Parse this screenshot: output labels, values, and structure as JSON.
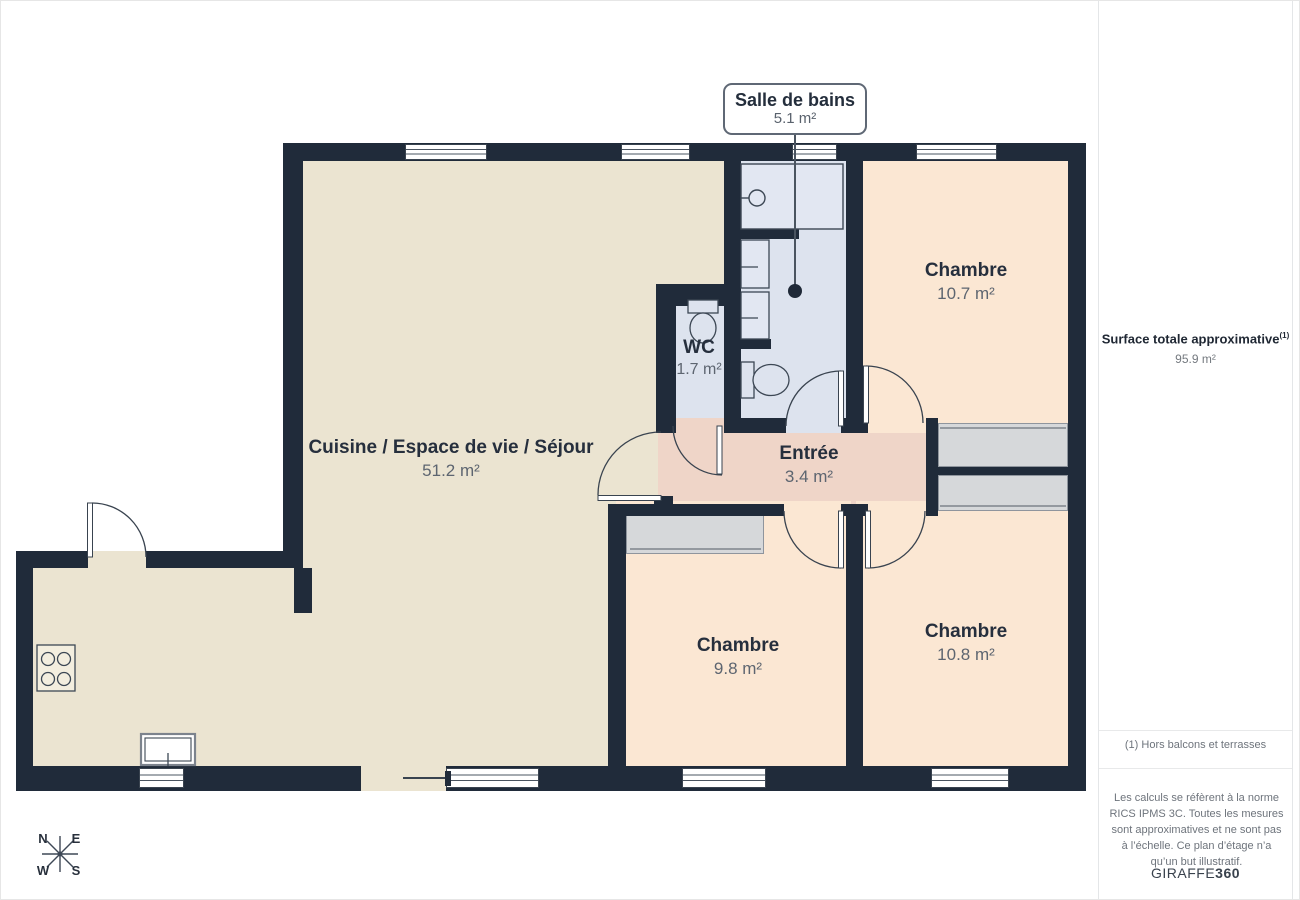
{
  "plan": {
    "callout": {
      "title": "Salle de bains",
      "area": "5.1 m²"
    },
    "rooms": [
      {
        "id": "cuisine",
        "label": "Cuisine / Espace de vie / Séjour",
        "area": "51.2 m²"
      },
      {
        "id": "wc",
        "label": "WC",
        "area": "1.7 m²"
      },
      {
        "id": "chambre1",
        "label": "Chambre",
        "area": "10.7 m²"
      },
      {
        "id": "entree",
        "label": "Entrée",
        "area": "3.4 m²"
      },
      {
        "id": "chambre2",
        "label": "Chambre",
        "area": "9.8 m²"
      },
      {
        "id": "chambre3",
        "label": "Chambre",
        "area": "10.8 m²"
      }
    ],
    "compass": {
      "n": "N",
      "e": "E",
      "s": "S",
      "w": "W"
    }
  },
  "sidebar": {
    "title": "Surface totale approximative",
    "title_sup": "(1)",
    "total_area": "95.9 m²",
    "footnote": "(1) Hors balcons et terrasses",
    "disclaimer": "Les calculs se réfèrent à la norme RICS IPMS 3C. Toutes les mesures sont approximatives et ne sont pas à l’échelle. Ce plan d’étage n’a qu’un but illustratif.",
    "brand_name": "GIRAFFE",
    "brand_suffix": "360"
  },
  "colors": {
    "wall": "#202b3a",
    "floor_living": "#ebe4d1",
    "floor_bedroom": "#fbe7d3",
    "floor_entry": "#efd5c8",
    "floor_bath": "#dde3ee",
    "closet": "#d6d8da",
    "text_dark": "#262f3d",
    "text_gray": "#6e747c"
  }
}
